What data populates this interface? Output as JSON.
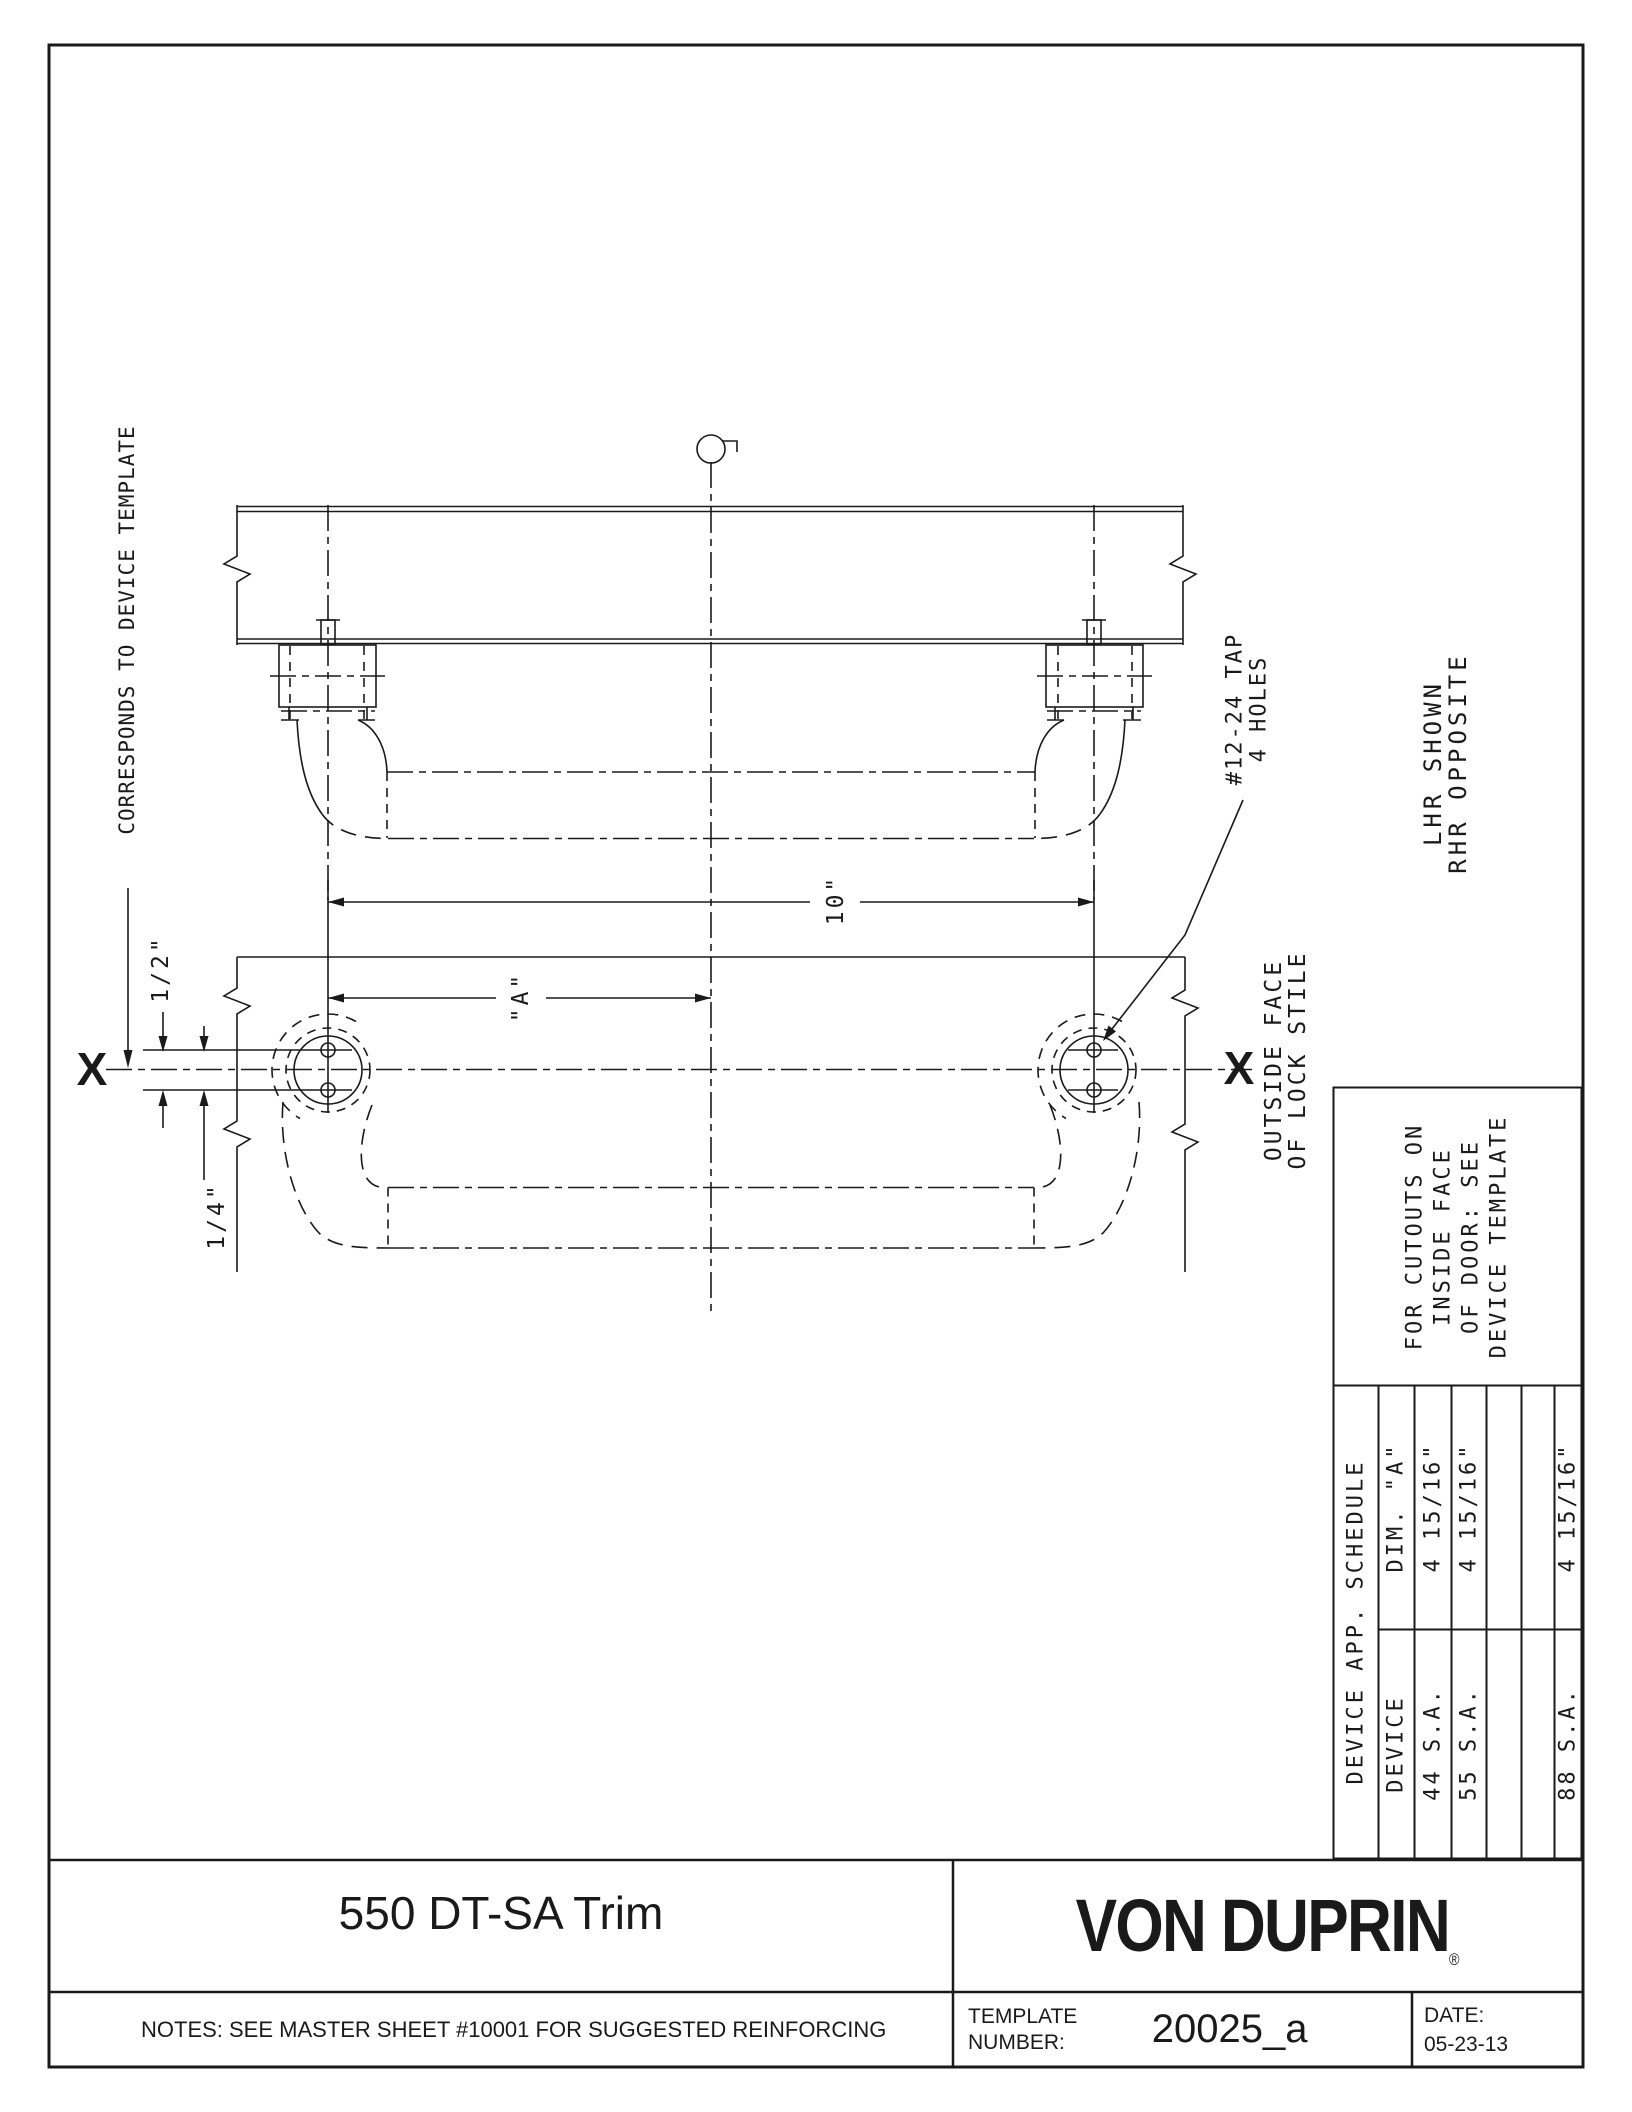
{
  "title_block": {
    "product_title": "550 DT-SA Trim",
    "brand": "VON DUPRIN",
    "brand_mark": "®",
    "notes": "NOTES: SEE MASTER SHEET #10001 FOR SUGGESTED REINFORCING",
    "template_label_line1": "TEMPLATE",
    "template_label_line2": "NUMBER:",
    "template_number": "20025_a",
    "date_label": "DATE:",
    "date_value": "05-23-13"
  },
  "schedule": {
    "title": "DEVICE APP. SCHEDULE",
    "columns": [
      "DEVICE",
      "DIM. \"A\""
    ],
    "rows": [
      [
        "44 S.A.",
        "4 15/16\""
      ],
      [
        "55 S.A.",
        "4 15/16\""
      ],
      [
        "",
        ""
      ],
      [
        "",
        ""
      ],
      [
        "88 S.A.",
        "4 15/16\""
      ]
    ],
    "note_lines": [
      "FOR CUTOUTS ON",
      "INSIDE FACE",
      "OF DOOR: SEE",
      "DEVICE TEMPLATE"
    ]
  },
  "labels": {
    "corresponds": "CORRESPONDS TO DEVICE TEMPLATE",
    "half": "1/2\"",
    "quarter": "1/4\"",
    "ten": "10\"",
    "dim_a": "\"A\"",
    "tap_line1": "#12-24 TAP",
    "tap_line2": "4 HOLES",
    "outside_line1": "OUTSIDE FACE",
    "outside_line2": "OF LOCK STILE",
    "hand_line1": "LHR SHOWN",
    "hand_line2": "RHR OPPOSITE",
    "x_mark": "X"
  },
  "colors": {
    "line": "#1a1a1a",
    "background": "#ffffff"
  }
}
